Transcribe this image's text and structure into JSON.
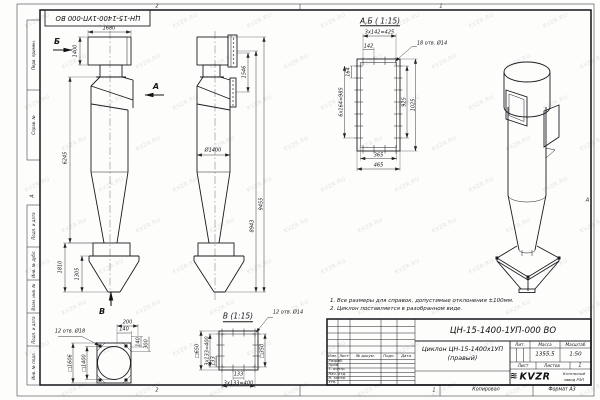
{
  "sheet": {
    "top_stamp": "ЦН-15-1400-1УП-000 ВО",
    "zones": {
      "top_left": "2",
      "top_right": "1",
      "bottom_left": "2",
      "bottom_mid": "1",
      "left": "А",
      "right": "А"
    },
    "strip": {
      "kopiroval": "Копировал",
      "format": "Формат А3"
    },
    "left_column": [
      "Перв. примен.",
      "Справ. №",
      "Подп. и дата",
      "Инв. № дубл.",
      "Взам. инв. №",
      "Подп. и дата",
      "Инв. № подл."
    ]
  },
  "notes": [
    "1. Все размеры для справок, допустимые отклонения ±100мм.",
    "2. Циклон поставляется в разобранном виде."
  ],
  "title_block": {
    "designation": "ЦН-15-1400-1УП-000 ВО",
    "name_line1": "Циклон ЦН-15-1400х1УП",
    "name_line2": "(правый)",
    "headers": {
      "izm": "Изм.",
      "list": "Лист",
      "doc": "№ докум.",
      "podp": "Подп.",
      "data": "Дата",
      "lit": "Лит.",
      "massa": "Масса",
      "masshtab": "Масштаб",
      "sheet": "Лист",
      "sheets": "Листов"
    },
    "rows": [
      "Разраб.",
      "Пров.",
      "Т. контр.",
      "Нач. отд.",
      "Н. контр.",
      "Утв."
    ],
    "massa_value": "1355,5",
    "scale_value": "1:50",
    "sheets_value": "1",
    "logo_glyph": "≋",
    "logo_text": "KVZR",
    "company_line1": "Котельный",
    "company_line2": "завод РЭП"
  },
  "watermark": {
    "text": "KVZR.RU"
  },
  "annotations": [
    {
      "n": "dim-front-width-1680",
      "t": "1680",
      "x": 109,
      "y": 28.5
    },
    {
      "n": "dim-front-inlet-height-1400",
      "t": "1400",
      "x": 76,
      "y": 51,
      "r": -90
    },
    {
      "n": "dim-front-height-6245",
      "t": "6245",
      "x": 66,
      "y": 158,
      "r": -90
    },
    {
      "n": "dim-front-bunker-1810",
      "t": "1810",
      "x": 61,
      "y": 267,
      "r": -90
    },
    {
      "n": "dim-front-bunker-1305",
      "t": "1305",
      "x": 78,
      "y": 274,
      "r": -90
    },
    {
      "n": "view-direction-label-b",
      "t": "Б",
      "x": 57,
      "y": 42,
      "fs": 8,
      "b": 1
    },
    {
      "n": "view-direction-label-a",
      "t": "А",
      "x": 156,
      "y": 87,
      "fs": 8,
      "b": 1
    },
    {
      "n": "view-direction-label-v",
      "t": "В",
      "x": 102,
      "y": 312,
      "fs": 8,
      "b": 1
    },
    {
      "n": "dim-side-1546",
      "t": "1546",
      "x": 244.5,
      "y": 72,
      "r": -90
    },
    {
      "n": "dim-side-diameter-1400",
      "t": "Ø1400",
      "x": 213,
      "y": 150.5
    },
    {
      "n": "dim-side-8943",
      "t": "8943",
      "x": 252.5,
      "y": 226,
      "r": -90
    },
    {
      "n": "dim-side-9455",
      "t": "9455",
      "x": 261.5,
      "y": 204,
      "r": -90
    },
    {
      "n": "section-ab-title",
      "t": "А,Б ( 1:15)",
      "x": 380,
      "y": 21.5,
      "fs": 7.5,
      "u": 1
    },
    {
      "n": "dim-ab-3x142",
      "t": "3x142=425",
      "x": 379.5,
      "y": 32.5
    },
    {
      "n": "dim-ab-142",
      "t": "142",
      "x": 368.5,
      "y": 47
    },
    {
      "n": "dim-ab-164",
      "t": "164",
      "x": 349,
      "y": 72,
      "r": -90
    },
    {
      "n": "dim-ab-6x164",
      "t": "6x164=985",
      "x": 342,
      "y": 102,
      "r": -90
    },
    {
      "n": "dim-ab-925",
      "t": "925",
      "x": 404.5,
      "y": 102,
      "r": -90
    },
    {
      "n": "dim-ab-1025",
      "t": "1025",
      "x": 413.5,
      "y": 105,
      "r": -90
    },
    {
      "n": "dim-ab-365",
      "t": "365",
      "x": 378.5,
      "y": 155.5
    },
    {
      "n": "dim-ab-465",
      "t": "465",
      "x": 378.5,
      "y": 166
    },
    {
      "n": "callout-ab-holes",
      "t": "18 отв. Ø14",
      "x": 432,
      "y": 44
    },
    {
      "n": "view-v-title",
      "t": "В (1:15)",
      "x": 238,
      "y": 317,
      "fs": 7.5,
      "u": 1
    },
    {
      "n": "callout-v-holes",
      "t": "12 отв. Ø14",
      "x": 288,
      "y": 313
    },
    {
      "n": "dim-v-650",
      "t": "□650",
      "x": 198,
      "y": 350.5,
      "r": -90
    },
    {
      "n": "dim-v-3x133-left",
      "t": "3x133=400",
      "x": 207.5,
      "y": 350.5,
      "r": -90
    },
    {
      "n": "dim-v-133-left",
      "t": "133",
      "x": 213.5,
      "y": 361,
      "r": -90
    },
    {
      "n": "dim-v-350",
      "t": "□350",
      "x": 263,
      "y": 350.5,
      "r": -90
    },
    {
      "n": "dim-v-133-bottom",
      "t": "133",
      "x": 238.5,
      "y": 375
    },
    {
      "n": "dim-v-3x133-bottom",
      "t": "3x133=400",
      "x": 238.5,
      "y": 383.5
    },
    {
      "n": "callout-plan-holes",
      "t": "12 отв. Ø18",
      "x": 70,
      "y": 332
    },
    {
      "n": "dim-plan-1606",
      "t": "□1606",
      "x": 70.5,
      "y": 363,
      "r": -90
    },
    {
      "n": "dim-plan-1400",
      "t": "□1400",
      "x": 84.5,
      "y": 363,
      "r": -90
    },
    {
      "n": "dim-plan-200",
      "t": "200",
      "x": 127.5,
      "y": 322.5
    },
    {
      "n": "dim-plan-140-h",
      "t": "140",
      "x": 124,
      "y": 330
    },
    {
      "n": "dim-plan-140-v",
      "t": "140",
      "x": 138.5,
      "y": 341.5,
      "r": -90
    },
    {
      "n": "dim-plan-300",
      "t": "300",
      "x": 146.5,
      "y": 344,
      "r": -90
    }
  ]
}
